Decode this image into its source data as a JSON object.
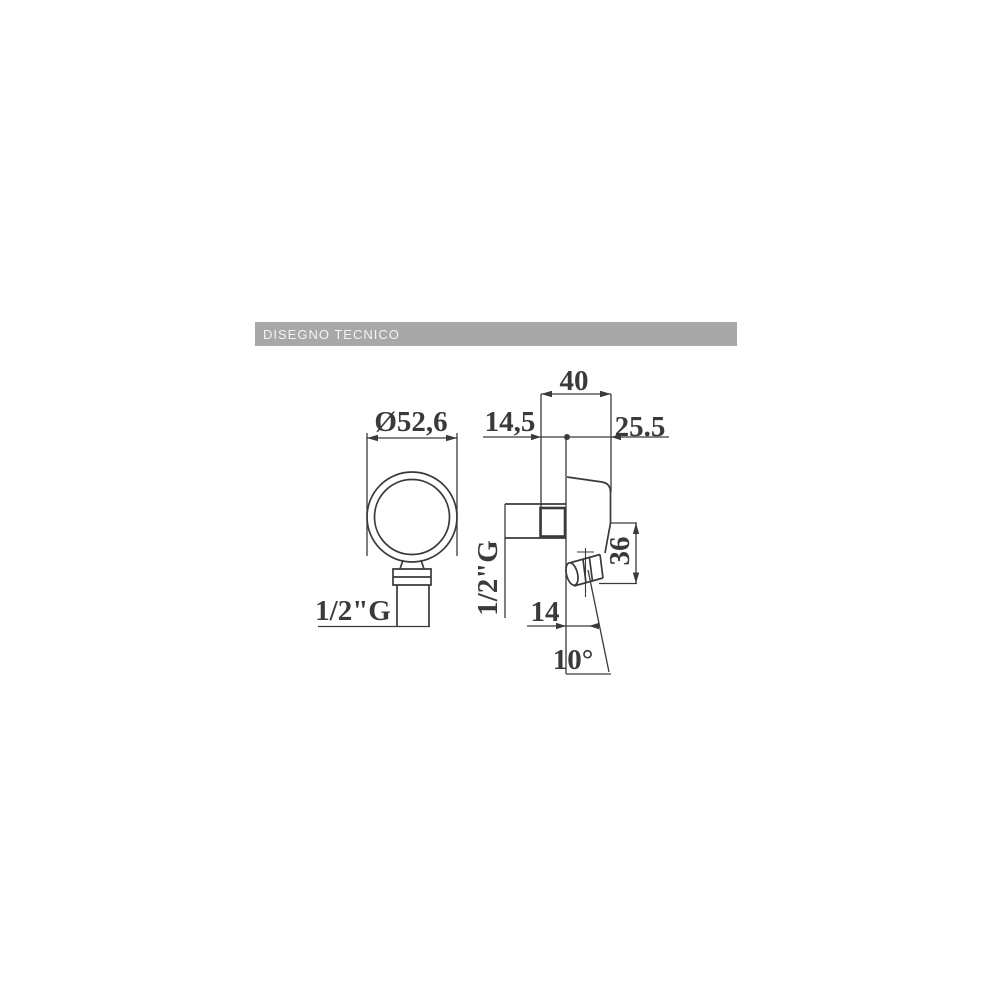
{
  "header": {
    "label": "DISEGNO TECNICO",
    "bg_color": "#a8a8a8",
    "text_color": "#f4f4f4"
  },
  "drawing": {
    "line_color": "#3a3a3a",
    "front_view": {
      "diameter_label": "Ø52,6",
      "thread_label": "1/2\"G"
    },
    "side_view": {
      "width_label": "40",
      "depth_rear_label": "14,5",
      "depth_front_label": "25.5",
      "thread_label": "1/2\"G",
      "height_label": "36",
      "offset_label": "14",
      "angle_label": "10°"
    }
  }
}
